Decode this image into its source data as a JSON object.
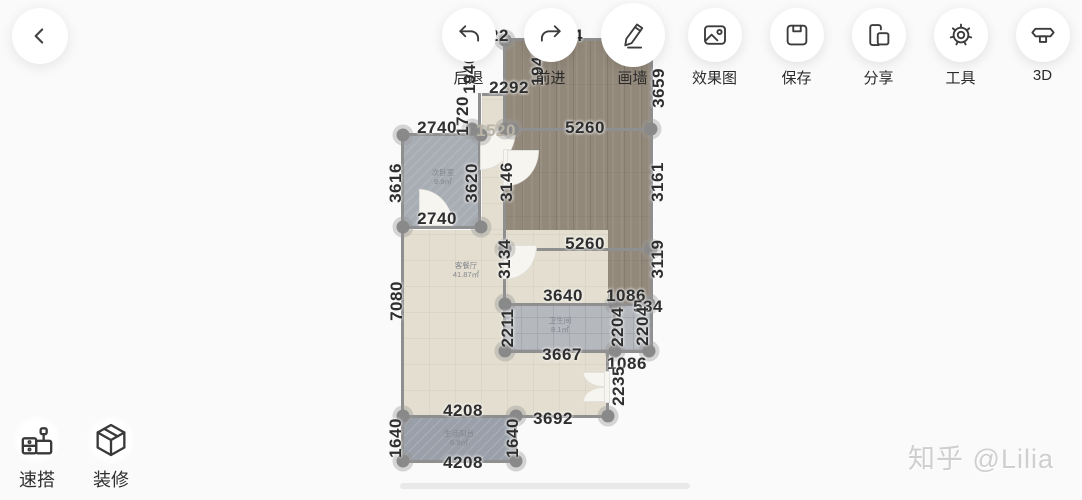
{
  "header": {
    "back_icon": "chevron-left"
  },
  "toolbar": {
    "items": [
      {
        "id": "undo",
        "label": "后退",
        "active": false
      },
      {
        "id": "redo",
        "label": "前进",
        "active": false
      },
      {
        "id": "draw-wall",
        "label": "画墙",
        "active": true
      },
      {
        "id": "render",
        "label": "效果图",
        "active": false
      },
      {
        "id": "save",
        "label": "保存",
        "active": false
      },
      {
        "id": "share",
        "label": "分享",
        "active": false
      },
      {
        "id": "tools",
        "label": "工具",
        "active": false
      },
      {
        "id": "3d",
        "label": "3D",
        "active": false
      }
    ]
  },
  "dock": {
    "items": [
      {
        "id": "quick-build",
        "label": "速搭"
      },
      {
        "id": "decorate",
        "label": "装修"
      }
    ]
  },
  "watermark": {
    "text": "知乎 @Lilia"
  },
  "floorplan": {
    "unit": "mm",
    "dimensions": [
      {
        "text": "22",
        "x": 499,
        "y": 36,
        "rot": 0,
        "faint": false
      },
      {
        "text": "4",
        "x": 578,
        "y": 36,
        "rot": 0,
        "faint": false
      },
      {
        "text": "1940",
        "x": 470,
        "y": 74,
        "rot": 90,
        "faint": false
      },
      {
        "text": "1940",
        "x": 538,
        "y": 66,
        "rot": 90,
        "faint": false
      },
      {
        "text": "2292",
        "x": 509,
        "y": 88,
        "rot": 0,
        "faint": false
      },
      {
        "text": "1720",
        "x": 463,
        "y": 116,
        "rot": 90,
        "faint": false
      },
      {
        "text": "3659",
        "x": 659,
        "y": 88,
        "rot": 90,
        "faint": false
      },
      {
        "text": "2740",
        "x": 437,
        "y": 128,
        "rot": 0,
        "faint": false
      },
      {
        "text": "1520",
        "x": 496,
        "y": 131,
        "rot": 0,
        "faint": true
      },
      {
        "text": "5260",
        "x": 585,
        "y": 128,
        "rot": 0,
        "faint": false
      },
      {
        "text": "3616",
        "x": 396,
        "y": 183,
        "rot": 90,
        "faint": false
      },
      {
        "text": "3620",
        "x": 472,
        "y": 183,
        "rot": 90,
        "faint": false
      },
      {
        "text": "3146",
        "x": 507,
        "y": 182,
        "rot": 90,
        "faint": false
      },
      {
        "text": "3161",
        "x": 658,
        "y": 182,
        "rot": 90,
        "faint": false
      },
      {
        "text": "2740",
        "x": 437,
        "y": 219,
        "rot": 0,
        "faint": false
      },
      {
        "text": "5260",
        "x": 585,
        "y": 244,
        "rot": 0,
        "faint": false
      },
      {
        "text": "3134",
        "x": 505,
        "y": 259,
        "rot": 90,
        "faint": false
      },
      {
        "text": "3119",
        "x": 658,
        "y": 259,
        "rot": 90,
        "faint": false
      },
      {
        "text": "7080",
        "x": 397,
        "y": 301,
        "rot": 90,
        "faint": false
      },
      {
        "text": "3640",
        "x": 563,
        "y": 296,
        "rot": 0,
        "faint": false
      },
      {
        "text": "1086",
        "x": 626,
        "y": 296,
        "rot": 0,
        "faint": false
      },
      {
        "text": "534",
        "x": 648,
        "y": 307,
        "rot": 0,
        "faint": false
      },
      {
        "text": "2211",
        "x": 508,
        "y": 328,
        "rot": 90,
        "faint": false
      },
      {
        "text": "2204",
        "x": 618,
        "y": 327,
        "rot": 90,
        "faint": false
      },
      {
        "text": "2204",
        "x": 643,
        "y": 326,
        "rot": 90,
        "faint": false
      },
      {
        "text": "3667",
        "x": 562,
        "y": 355,
        "rot": 0,
        "faint": false
      },
      {
        "text": "1086",
        "x": 627,
        "y": 364,
        "rot": 0,
        "faint": false
      },
      {
        "text": "2235",
        "x": 619,
        "y": 386,
        "rot": 90,
        "faint": false
      },
      {
        "text": "4208",
        "x": 463,
        "y": 411,
        "rot": 0,
        "faint": false
      },
      {
        "text": "3692",
        "x": 553,
        "y": 419,
        "rot": 0,
        "faint": false
      },
      {
        "text": "1640",
        "x": 396,
        "y": 438,
        "rot": 90,
        "faint": false
      },
      {
        "text": "1640",
        "x": 513,
        "y": 438,
        "rot": 90,
        "faint": false
      },
      {
        "text": "4208",
        "x": 463,
        "y": 463,
        "rot": 0,
        "faint": false
      }
    ],
    "rooms": [
      {
        "name": "次卧室",
        "area": "9.9㎡",
        "x": 443,
        "y": 177
      },
      {
        "name": "客餐厅",
        "area": "41.87㎡",
        "x": 466,
        "y": 270
      },
      {
        "name": "卫生间",
        "area": "8.1㎡",
        "x": 560,
        "y": 325
      },
      {
        "name": "生活阳台",
        "area": "6.9㎡",
        "x": 459,
        "y": 438
      }
    ]
  }
}
